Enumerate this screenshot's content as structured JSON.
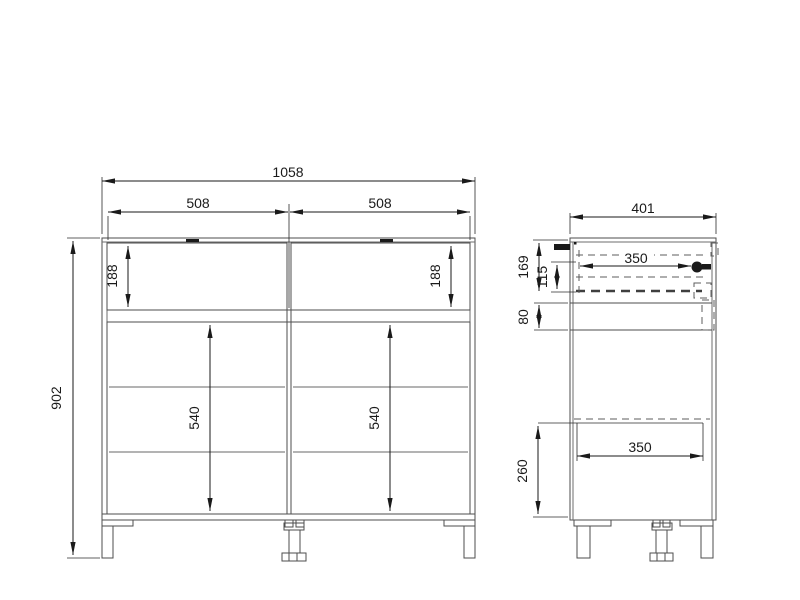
{
  "drawing": {
    "type": "furniture technical drawing (cabinet, front and side orthographic views)",
    "front_view": {
      "dims": {
        "total_width": "1058",
        "left_drawer_width": "508",
        "right_drawer_width": "508",
        "left_drawer_height": "188",
        "right_drawer_height": "188",
        "total_height": "902",
        "left_door_height": "540",
        "right_door_height": "540"
      }
    },
    "side_view": {
      "dims": {
        "depth": "401",
        "drawer_zone_height": "169",
        "drawer_side_height": "115",
        "rail_gap": "80",
        "drawer_slide_length": "350",
        "shelf_depth": "350",
        "base_zone_height": "260"
      }
    },
    "colors": {
      "background": "#ffffff",
      "object_line": "#4d4d4d",
      "dimension_line": "#1a1a1a",
      "hidden_line": "#5c5c5c",
      "shelf_line": "#b3b3b3"
    }
  }
}
